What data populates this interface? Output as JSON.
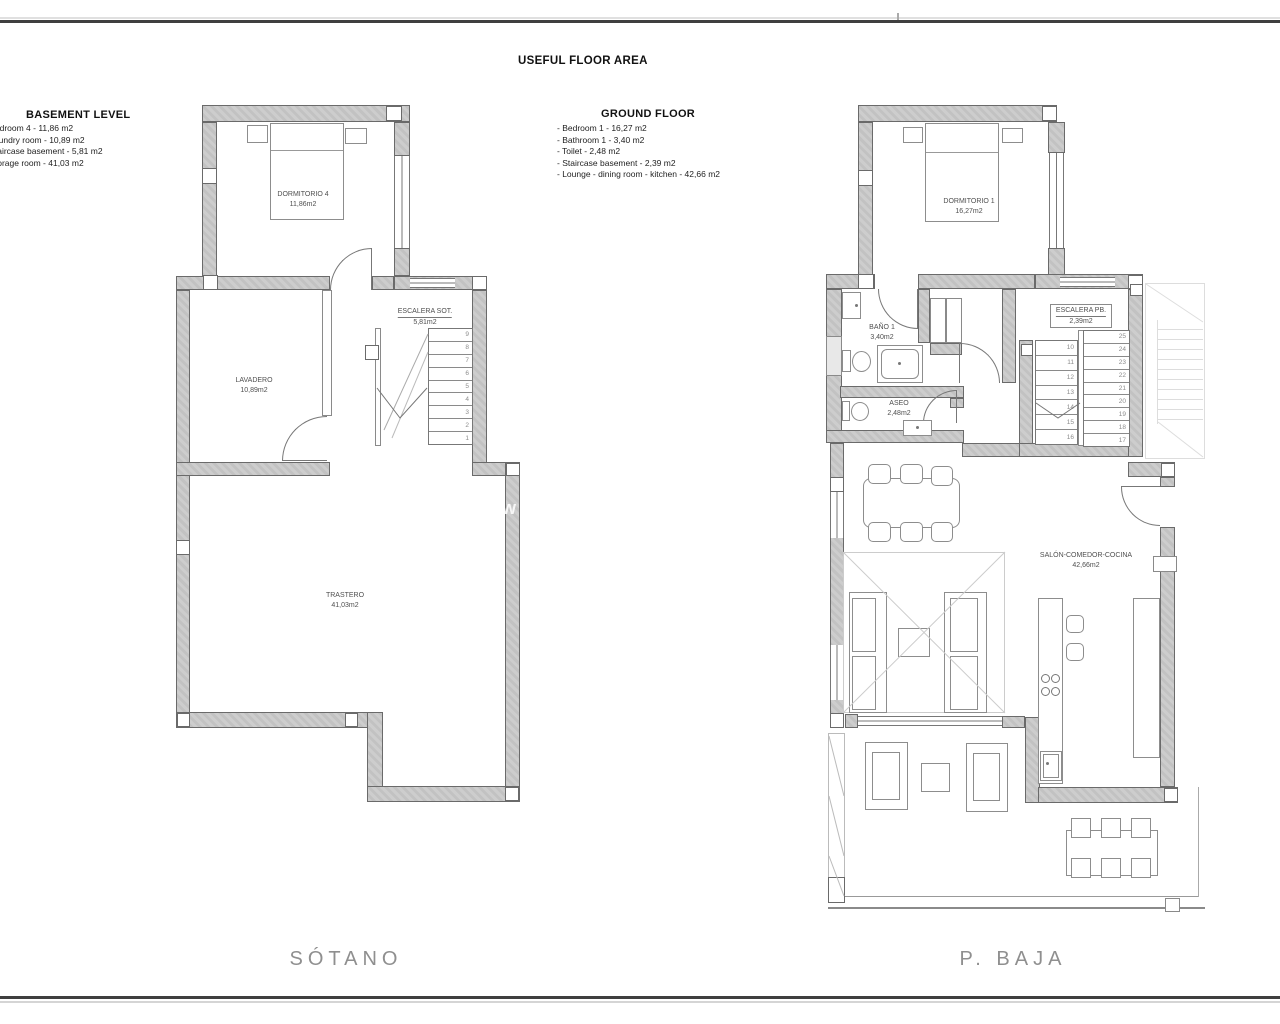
{
  "header": {
    "title": "USEFUL FLOOR AREA"
  },
  "legend": {
    "basement": {
      "heading": "BASEMENT LEVEL",
      "items": [
        "- Bedroom 4 - 11,86 m2",
        "- Laundry room - 10,89 m2",
        "- Staircase basement - 5,81 m2",
        "- Storage room - 41,03 m2"
      ]
    },
    "ground": {
      "heading": "GROUND FLOOR",
      "items": [
        "- Bedroom 1 - 16,27 m2",
        "- Bathroom 1 - 3,40 m2",
        "- Toilet - 2,48 m2",
        "- Staircase basement - 2,39 m2",
        "- Lounge - dining room - kitchen - 42,66 m2"
      ]
    }
  },
  "basement_plan": {
    "name": "SÓTANO",
    "rooms": {
      "bedroom": {
        "label": "DORMITORIO 4",
        "area": "11,86m2"
      },
      "laundry": {
        "label": "LAVADERO",
        "area": "10,89m2"
      },
      "stairs": {
        "label": "ESCALERA SOT.",
        "area": "5,81m2"
      },
      "storage": {
        "label": "TRASTERO",
        "area": "41,03m2"
      }
    },
    "stair_numbers": [
      "9",
      "8",
      "7",
      "6",
      "5",
      "4",
      "3",
      "2",
      "1"
    ]
  },
  "ground_plan": {
    "name": "P. BAJA",
    "rooms": {
      "bedroom": {
        "label": "DORMITORIO 1",
        "area": "16,27m2"
      },
      "bath": {
        "label": "BAÑO 1",
        "area": "3,40m2"
      },
      "toilet": {
        "label": "ASEO",
        "area": "2,48m2"
      },
      "stairs": {
        "label": "ESCALERA PB.",
        "area": "2,39m2"
      },
      "living": {
        "label": "SALÓN-COMEDOR-COCINA",
        "area": "42,66m2"
      }
    },
    "stair_numbers_left": [
      "10",
      "11",
      "12",
      "13",
      "14",
      "15",
      "16"
    ],
    "stair_numbers_right": [
      "25",
      "24",
      "23",
      "22",
      "21",
      "20",
      "19",
      "18",
      "17"
    ]
  },
  "watermark": "w",
  "colors": {
    "wall_fill": "#c9c9c9",
    "wall_line": "#6a6a6a",
    "label_text": "#4f4f4f",
    "floor_name_text": "#8f8f8f"
  }
}
